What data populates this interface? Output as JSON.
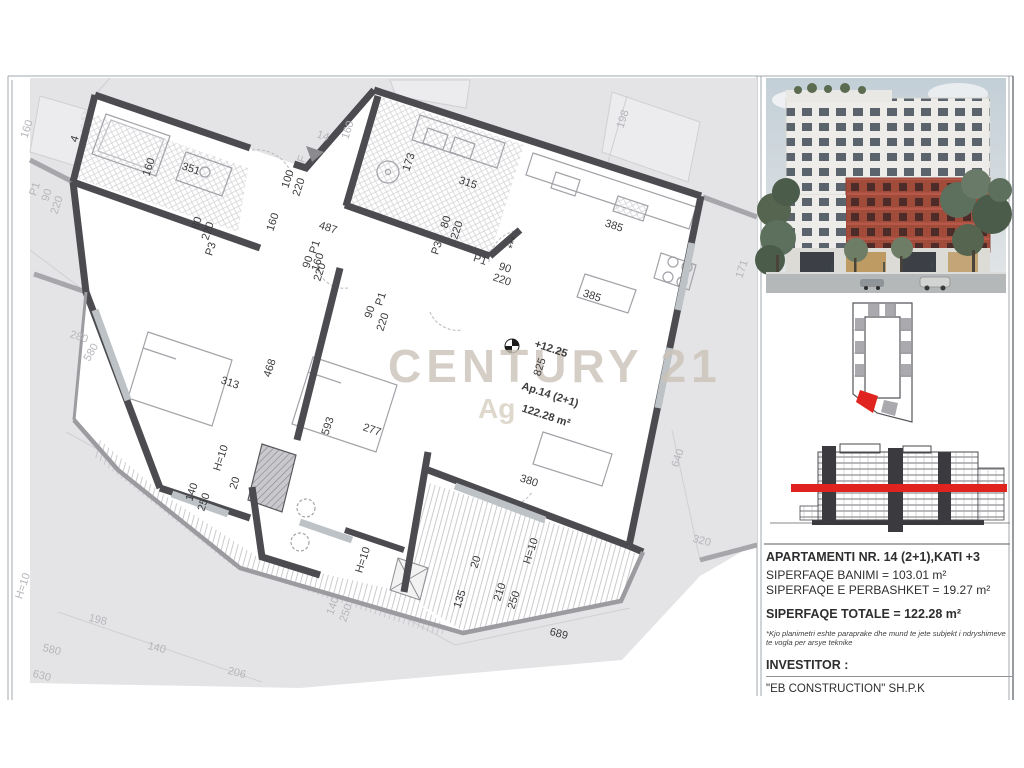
{
  "watermark": {
    "brand": "CENTURY 21",
    "sub": "Ag"
  },
  "plan": {
    "labels": [
      {
        "t": "351",
        "x": 190,
        "y": 172,
        "r": 18
      },
      {
        "t": "160",
        "x": 152,
        "y": 168,
        "r": -72
      },
      {
        "t": "4",
        "x": 78,
        "y": 140,
        "r": -72,
        "s": 10
      },
      {
        "t": "100",
        "x": 291,
        "y": 180,
        "r": -72,
        "s": 10
      },
      {
        "t": "220",
        "x": 302,
        "y": 188,
        "r": -72,
        "s": 10
      },
      {
        "t": "173",
        "x": 412,
        "y": 163,
        "r": -72
      },
      {
        "t": "315",
        "x": 467,
        "y": 186,
        "r": 18
      },
      {
        "t": "80",
        "x": 449,
        "y": 223,
        "r": -72,
        "s": 10
      },
      {
        "t": "220",
        "x": 460,
        "y": 231,
        "r": -72,
        "s": 10
      },
      {
        "t": "P3",
        "x": 440,
        "y": 249,
        "r": -72,
        "s": 10
      },
      {
        "t": "***",
        "x": 517,
        "y": 244,
        "r": -72,
        "s": 10
      },
      {
        "t": "P1",
        "x": 479,
        "y": 263,
        "r": 18,
        "s": 10
      },
      {
        "t": "90",
        "x": 504,
        "y": 271,
        "r": 18,
        "s": 10
      },
      {
        "t": "220",
        "x": 501,
        "y": 283,
        "r": 18,
        "s": 10
      },
      {
        "t": "80",
        "x": 200,
        "y": 224,
        "r": -72,
        "s": 10
      },
      {
        "t": "220",
        "x": 211,
        "y": 232,
        "r": -72,
        "s": 10
      },
      {
        "t": "P3",
        "x": 214,
        "y": 250,
        "r": -72,
        "s": 10
      },
      {
        "t": "P1",
        "x": 318,
        "y": 248,
        "r": -72,
        "s": 10
      },
      {
        "t": "90",
        "x": 311,
        "y": 263,
        "r": -72,
        "s": 10
      },
      {
        "t": "220",
        "x": 323,
        "y": 273,
        "r": -72,
        "s": 10
      },
      {
        "t": "160",
        "x": 276,
        "y": 223,
        "r": -72
      },
      {
        "t": "487",
        "x": 327,
        "y": 231,
        "r": 18
      },
      {
        "t": "160",
        "x": 321,
        "y": 263,
        "r": -72
      },
      {
        "t": "90",
        "x": 373,
        "y": 313,
        "r": -72,
        "s": 10
      },
      {
        "t": "P1",
        "x": 384,
        "y": 300,
        "r": -72,
        "s": 10
      },
      {
        "t": "220",
        "x": 386,
        "y": 323,
        "r": -72,
        "s": 10
      },
      {
        "t": "385",
        "x": 613,
        "y": 229,
        "r": 18
      },
      {
        "t": "385",
        "x": 591,
        "y": 299,
        "r": 18
      },
      {
        "t": "825",
        "x": 543,
        "y": 368,
        "r": -72
      },
      {
        "t": "+12.25",
        "x": 550,
        "y": 352,
        "r": 18,
        "s": 15,
        "w": 1
      },
      {
        "t": "Ap.14 (2+1)",
        "x": 549,
        "y": 398,
        "r": 18,
        "s": 14,
        "w": 1
      },
      {
        "t": "122.28 m²",
        "x": 545,
        "y": 419,
        "r": 18,
        "s": 14,
        "w": 1
      },
      {
        "t": "313",
        "x": 229,
        "y": 386,
        "r": 18
      },
      {
        "t": "468",
        "x": 273,
        "y": 369,
        "r": -72
      },
      {
        "t": "277",
        "x": 371,
        "y": 433,
        "r": 18
      },
      {
        "t": "593",
        "x": 331,
        "y": 427,
        "r": -72
      },
      {
        "t": "H=10",
        "x": 224,
        "y": 459,
        "r": -72,
        "s": 10
      },
      {
        "t": "20",
        "x": 238,
        "y": 484,
        "r": -72,
        "s": 10
      },
      {
        "t": "140",
        "x": 195,
        "y": 493,
        "r": -72
      },
      {
        "t": "250",
        "x": 207,
        "y": 503,
        "r": -72
      },
      {
        "t": "380",
        "x": 528,
        "y": 484,
        "r": 18
      },
      {
        "t": "H=10",
        "x": 534,
        "y": 552,
        "r": -72,
        "s": 10
      },
      {
        "t": "20",
        "x": 479,
        "y": 563,
        "r": -72,
        "s": 10
      },
      {
        "t": "135",
        "x": 463,
        "y": 600,
        "r": -72
      },
      {
        "t": "210",
        "x": 503,
        "y": 593,
        "r": -72
      },
      {
        "t": "250",
        "x": 517,
        "y": 601,
        "r": -72
      },
      {
        "t": "H=10",
        "x": 366,
        "y": 561,
        "r": -72,
        "s": 10
      },
      {
        "t": "689",
        "x": 558,
        "y": 637,
        "r": 14
      },
      {
        "t": "160",
        "x": 30,
        "y": 130,
        "r": -72,
        "c": "g"
      },
      {
        "t": "P1",
        "x": 38,
        "y": 190,
        "r": -72,
        "s": 10,
        "c": "g"
      },
      {
        "t": "90",
        "x": 50,
        "y": 196,
        "r": -72,
        "s": 10,
        "c": "g"
      },
      {
        "t": "220",
        "x": 60,
        "y": 206,
        "r": -72,
        "s": 10,
        "c": "g"
      },
      {
        "t": "280",
        "x": 78,
        "y": 340,
        "r": 18,
        "c": "g"
      },
      {
        "t": "580",
        "x": 94,
        "y": 354,
        "r": -60,
        "c": "g"
      },
      {
        "t": "H=10",
        "x": 26,
        "y": 587,
        "r": -72,
        "s": 10,
        "c": "g"
      },
      {
        "t": "198",
        "x": 97,
        "y": 623,
        "r": 14,
        "c": "g"
      },
      {
        "t": "580",
        "x": 51,
        "y": 653,
        "r": 14,
        "c": "g"
      },
      {
        "t": "630",
        "x": 41,
        "y": 679,
        "r": 14,
        "c": "g"
      },
      {
        "t": "140",
        "x": 156,
        "y": 651,
        "r": 14,
        "c": "g"
      },
      {
        "t": "206",
        "x": 236,
        "y": 676,
        "r": 14,
        "c": "g"
      },
      {
        "t": "14",
        "x": 322,
        "y": 139,
        "r": 18,
        "s": 10,
        "c": "g"
      },
      {
        "t": "F",
        "x": 305,
        "y": 160,
        "r": -72,
        "s": 10,
        "c": "g"
      },
      {
        "t": "160",
        "x": 351,
        "y": 131,
        "r": -72,
        "c": "g"
      },
      {
        "t": "198",
        "x": 626,
        "y": 120,
        "r": -72,
        "c": "g"
      },
      {
        "t": "171",
        "x": 745,
        "y": 270,
        "r": -72,
        "c": "g"
      },
      {
        "t": "640",
        "x": 681,
        "y": 459,
        "r": -72,
        "c": "g"
      },
      {
        "t": "320",
        "x": 701,
        "y": 544,
        "r": 14,
        "c": "g"
      },
      {
        "t": "140",
        "x": 336,
        "y": 607,
        "r": -70,
        "s": 9,
        "c": "g"
      },
      {
        "t": "250",
        "x": 349,
        "y": 614,
        "r": -70,
        "s": 9,
        "c": "g"
      }
    ]
  },
  "sidebar": {
    "info": {
      "title": "APARTAMENTI NR. 14 (2+1),KATI +3",
      "line_banimi": "SIPERFAQE BANIMI = 103.01 m²",
      "line_perbashket": "SIPERFAQE E PERBASHKET = 19.27 m²",
      "line_totale": "SIPERFAQE TOTALE = 122.28 m²",
      "note_line1": "*Kjo planimetri eshte paraprake dhe mund te jete subjekt i ndryshimeve",
      "note_line2": "te vogla per arsye teknike",
      "investor_label": "INVESTITOR :",
      "investor_name": "\"EB CONSTRUCTION\" SH.P.K"
    }
  },
  "colors": {
    "red": "#df2420",
    "wall": "#4c4c50",
    "parcel": "#e4e4e6",
    "brick": "#a14b3b",
    "gray_text": "#b6b6bb",
    "black_text": "#3c3c3e"
  }
}
